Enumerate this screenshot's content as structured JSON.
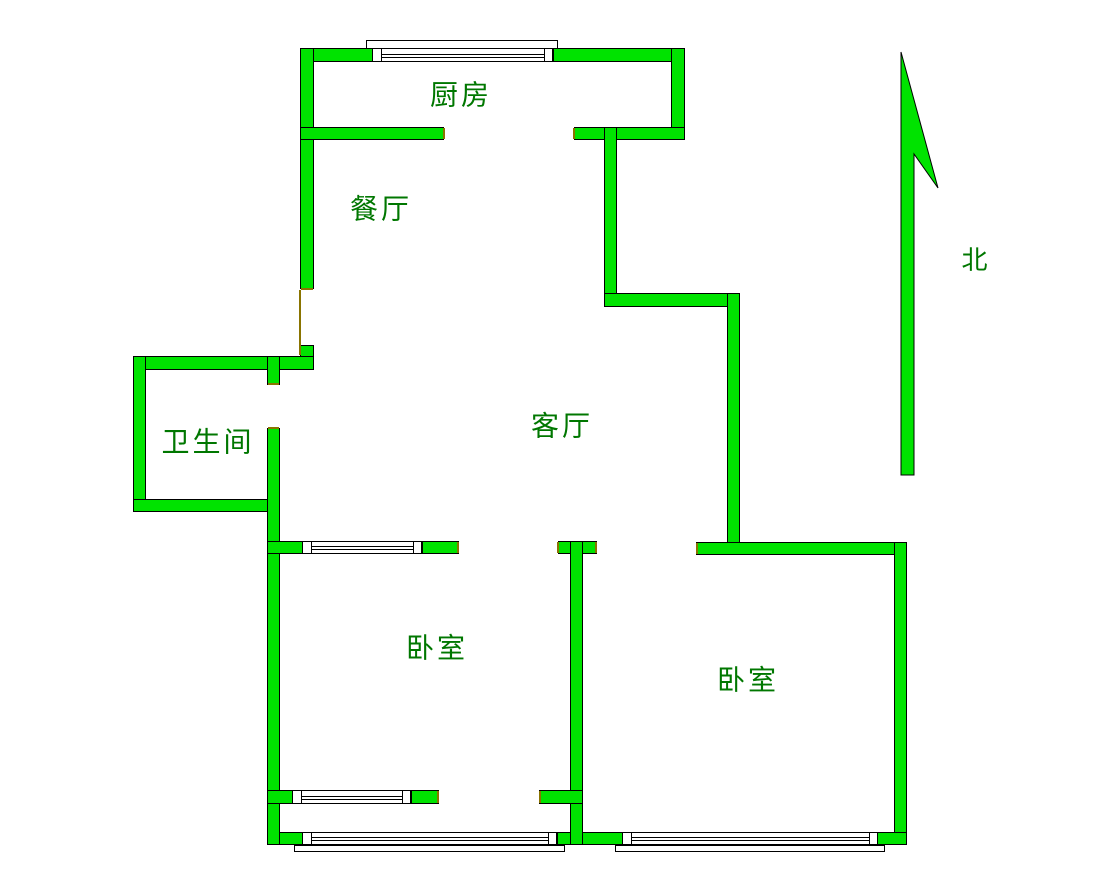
{
  "plan": {
    "canvas": {
      "width": 1111,
      "height": 876,
      "background": "#ffffff"
    },
    "colors": {
      "wall_fill": "#00E300",
      "wall_stroke": "#000000",
      "jamb": "#8A7400",
      "window_fill": "#FFFFFF",
      "label_text": "#007700"
    },
    "labels": [
      {
        "name": "room-label-kitchen",
        "text": "厨房",
        "x": 461,
        "y": 95,
        "size": 28
      },
      {
        "name": "room-label-dining",
        "text": "餐厅",
        "x": 381,
        "y": 209,
        "size": 28
      },
      {
        "name": "room-label-bathroom",
        "text": "卫生间",
        "x": 208,
        "y": 442,
        "size": 28
      },
      {
        "name": "room-label-living",
        "text": "客厅",
        "x": 562,
        "y": 426,
        "size": 28
      },
      {
        "name": "room-label-bedroom-west",
        "text": "卧室",
        "x": 437,
        "y": 648,
        "size": 28
      },
      {
        "name": "room-label-bedroom-east",
        "text": "卧室",
        "x": 748,
        "y": 680,
        "size": 28
      },
      {
        "name": "north-label",
        "text": "北",
        "x": 976,
        "y": 261,
        "size": 26
      }
    ],
    "walls": [
      {
        "name": "wall-outer-top-left",
        "x": 300,
        "y": 48,
        "w": 73,
        "h": 14
      },
      {
        "name": "wall-outer-top-right",
        "x": 553,
        "y": 48,
        "w": 132,
        "h": 14
      },
      {
        "name": "wall-west-upper",
        "x": 300,
        "y": 48,
        "w": 14,
        "h": 241
      },
      {
        "name": "wall-kitchen-east",
        "x": 671,
        "y": 48,
        "w": 14,
        "h": 92
      },
      {
        "name": "wall-kitchen-south-left",
        "x": 300,
        "y": 127,
        "w": 144,
        "h": 13
      },
      {
        "name": "wall-kitchen-south-right",
        "x": 574,
        "y": 127,
        "w": 111,
        "h": 13
      },
      {
        "name": "wall-living-east-upper",
        "x": 604,
        "y": 127,
        "w": 13,
        "h": 180
      },
      {
        "name": "wall-living-east-jog",
        "x": 604,
        "y": 293,
        "w": 136,
        "h": 14
      },
      {
        "name": "wall-living-east-lower",
        "x": 727,
        "y": 293,
        "w": 13,
        "h": 262
      },
      {
        "name": "wall-bedroom-east-north",
        "x": 696,
        "y": 542,
        "w": 211,
        "h": 13
      },
      {
        "name": "wall-east-outer",
        "x": 894,
        "y": 542,
        "w": 13,
        "h": 303
      },
      {
        "name": "wall-south-left",
        "x": 267,
        "y": 832,
        "w": 36,
        "h": 13
      },
      {
        "name": "wall-south-mid",
        "x": 557,
        "y": 832,
        "w": 66,
        "h": 13
      },
      {
        "name": "wall-south-right",
        "x": 877,
        "y": 832,
        "w": 30,
        "h": 13
      },
      {
        "name": "wall-west-mid",
        "x": 300,
        "y": 345,
        "w": 14,
        "h": 25
      },
      {
        "name": "wall-bath-north",
        "x": 133,
        "y": 356,
        "w": 181,
        "h": 14
      },
      {
        "name": "wall-bath-west",
        "x": 133,
        "y": 356,
        "w": 13,
        "h": 156
      },
      {
        "name": "wall-bath-south",
        "x": 133,
        "y": 499,
        "w": 147,
        "h": 13
      },
      {
        "name": "wall-bath-door-stub",
        "x": 267,
        "y": 356,
        "w": 13,
        "h": 29
      },
      {
        "name": "wall-west-lower",
        "x": 267,
        "y": 428,
        "w": 13,
        "h": 417
      },
      {
        "name": "wall-bedroom-west-north-a",
        "x": 267,
        "y": 541,
        "w": 36,
        "h": 13
      },
      {
        "name": "wall-bedroom-west-north-b",
        "x": 422,
        "y": 541,
        "w": 37,
        "h": 13
      },
      {
        "name": "wall-mid-cap",
        "x": 558,
        "y": 541,
        "w": 39,
        "h": 13
      },
      {
        "name": "wall-mid",
        "x": 570,
        "y": 541,
        "w": 13,
        "h": 304
      },
      {
        "name": "wall-bedroom-west-south-a",
        "x": 267,
        "y": 790,
        "w": 26,
        "h": 14
      },
      {
        "name": "wall-bedroom-west-south-b",
        "x": 411,
        "y": 790,
        "w": 28,
        "h": 14
      },
      {
        "name": "wall-mid-stub",
        "x": 539,
        "y": 790,
        "w": 44,
        "h": 14
      }
    ],
    "patches": [
      {
        "x": 301,
        "y": 49,
        "w": 12,
        "h": 12
      },
      {
        "x": 301,
        "y": 128,
        "w": 12,
        "h": 11
      },
      {
        "x": 672,
        "y": 49,
        "w": 12,
        "h": 12
      },
      {
        "x": 672,
        "y": 128,
        "w": 12,
        "h": 11
      },
      {
        "x": 605,
        "y": 128,
        "w": 11,
        "h": 11
      },
      {
        "x": 605,
        "y": 294,
        "w": 11,
        "h": 12
      },
      {
        "x": 728,
        "y": 294,
        "w": 11,
        "h": 12
      },
      {
        "x": 728,
        "y": 543,
        "w": 11,
        "h": 11
      },
      {
        "x": 895,
        "y": 543,
        "w": 11,
        "h": 11
      },
      {
        "x": 895,
        "y": 833,
        "w": 11,
        "h": 11
      },
      {
        "x": 301,
        "y": 357,
        "w": 12,
        "h": 12
      },
      {
        "x": 134,
        "y": 357,
        "w": 11,
        "h": 12
      },
      {
        "x": 134,
        "y": 500,
        "w": 11,
        "h": 11
      },
      {
        "x": 268,
        "y": 500,
        "w": 11,
        "h": 11
      },
      {
        "x": 268,
        "y": 357,
        "w": 11,
        "h": 12
      },
      {
        "x": 268,
        "y": 542,
        "w": 11,
        "h": 11
      },
      {
        "x": 268,
        "y": 791,
        "w": 11,
        "h": 12
      },
      {
        "x": 268,
        "y": 833,
        "w": 11,
        "h": 11
      },
      {
        "x": 571,
        "y": 542,
        "w": 11,
        "h": 11
      },
      {
        "x": 571,
        "y": 791,
        "w": 11,
        "h": 12
      },
      {
        "x": 571,
        "y": 833,
        "w": 11,
        "h": 11
      }
    ],
    "window_sills": [
      {
        "name": "sill-kitchen-north",
        "x": 366,
        "y": 40,
        "w": 192,
        "h": 9
      },
      {
        "name": "sill-south-west",
        "x": 294,
        "y": 845,
        "w": 271,
        "h": 7
      },
      {
        "name": "sill-south-east",
        "x": 615,
        "y": 845,
        "w": 270,
        "h": 7
      }
    ],
    "windows": [
      {
        "name": "window-kitchen-north",
        "x": 372,
        "y": 48,
        "w": 181,
        "h": 14,
        "post_xs": [
          381,
          544
        ],
        "line_ys": [
          54,
          57
        ]
      },
      {
        "name": "window-bedroom-west-north",
        "x": 302,
        "y": 541,
        "w": 120,
        "h": 13,
        "post_xs": [
          311,
          413
        ],
        "line_ys": [
          546,
          549
        ]
      },
      {
        "name": "window-bedroom-west-south",
        "x": 292,
        "y": 790,
        "w": 119,
        "h": 14,
        "post_xs": [
          301,
          402
        ],
        "line_ys": [
          796,
          799
        ]
      },
      {
        "name": "window-south-west",
        "x": 302,
        "y": 832,
        "w": 255,
        "h": 13,
        "post_xs": [
          311,
          548
        ],
        "line_ys": [
          837,
          840
        ]
      },
      {
        "name": "window-south-east",
        "x": 622,
        "y": 832,
        "w": 256,
        "h": 13,
        "post_xs": [
          631,
          869
        ],
        "line_ys": [
          837,
          840
        ]
      }
    ],
    "jambs": [
      {
        "x1": 444,
        "y1": 128,
        "x2": 444,
        "y2": 139
      },
      {
        "x1": 574,
        "y1": 128,
        "x2": 574,
        "y2": 139
      },
      {
        "x1": 300,
        "y1": 290,
        "x2": 300,
        "y2": 355
      },
      {
        "x1": 301,
        "y1": 289,
        "x2": 313,
        "y2": 289
      },
      {
        "x1": 268,
        "y1": 384,
        "x2": 279,
        "y2": 384
      },
      {
        "x1": 268,
        "y1": 428,
        "x2": 279,
        "y2": 428
      },
      {
        "x1": 458,
        "y1": 542,
        "x2": 458,
        "y2": 553
      },
      {
        "x1": 558,
        "y1": 542,
        "x2": 558,
        "y2": 553
      },
      {
        "x1": 596,
        "y1": 542,
        "x2": 596,
        "y2": 553
      },
      {
        "x1": 697,
        "y1": 543,
        "x2": 697,
        "y2": 554
      },
      {
        "x1": 438,
        "y1": 791,
        "x2": 438,
        "y2": 803
      },
      {
        "x1": 540,
        "y1": 791,
        "x2": 540,
        "y2": 803
      }
    ],
    "north_arrow": {
      "points": "901,52 938,188 914,154 914,475 901,475"
    }
  }
}
